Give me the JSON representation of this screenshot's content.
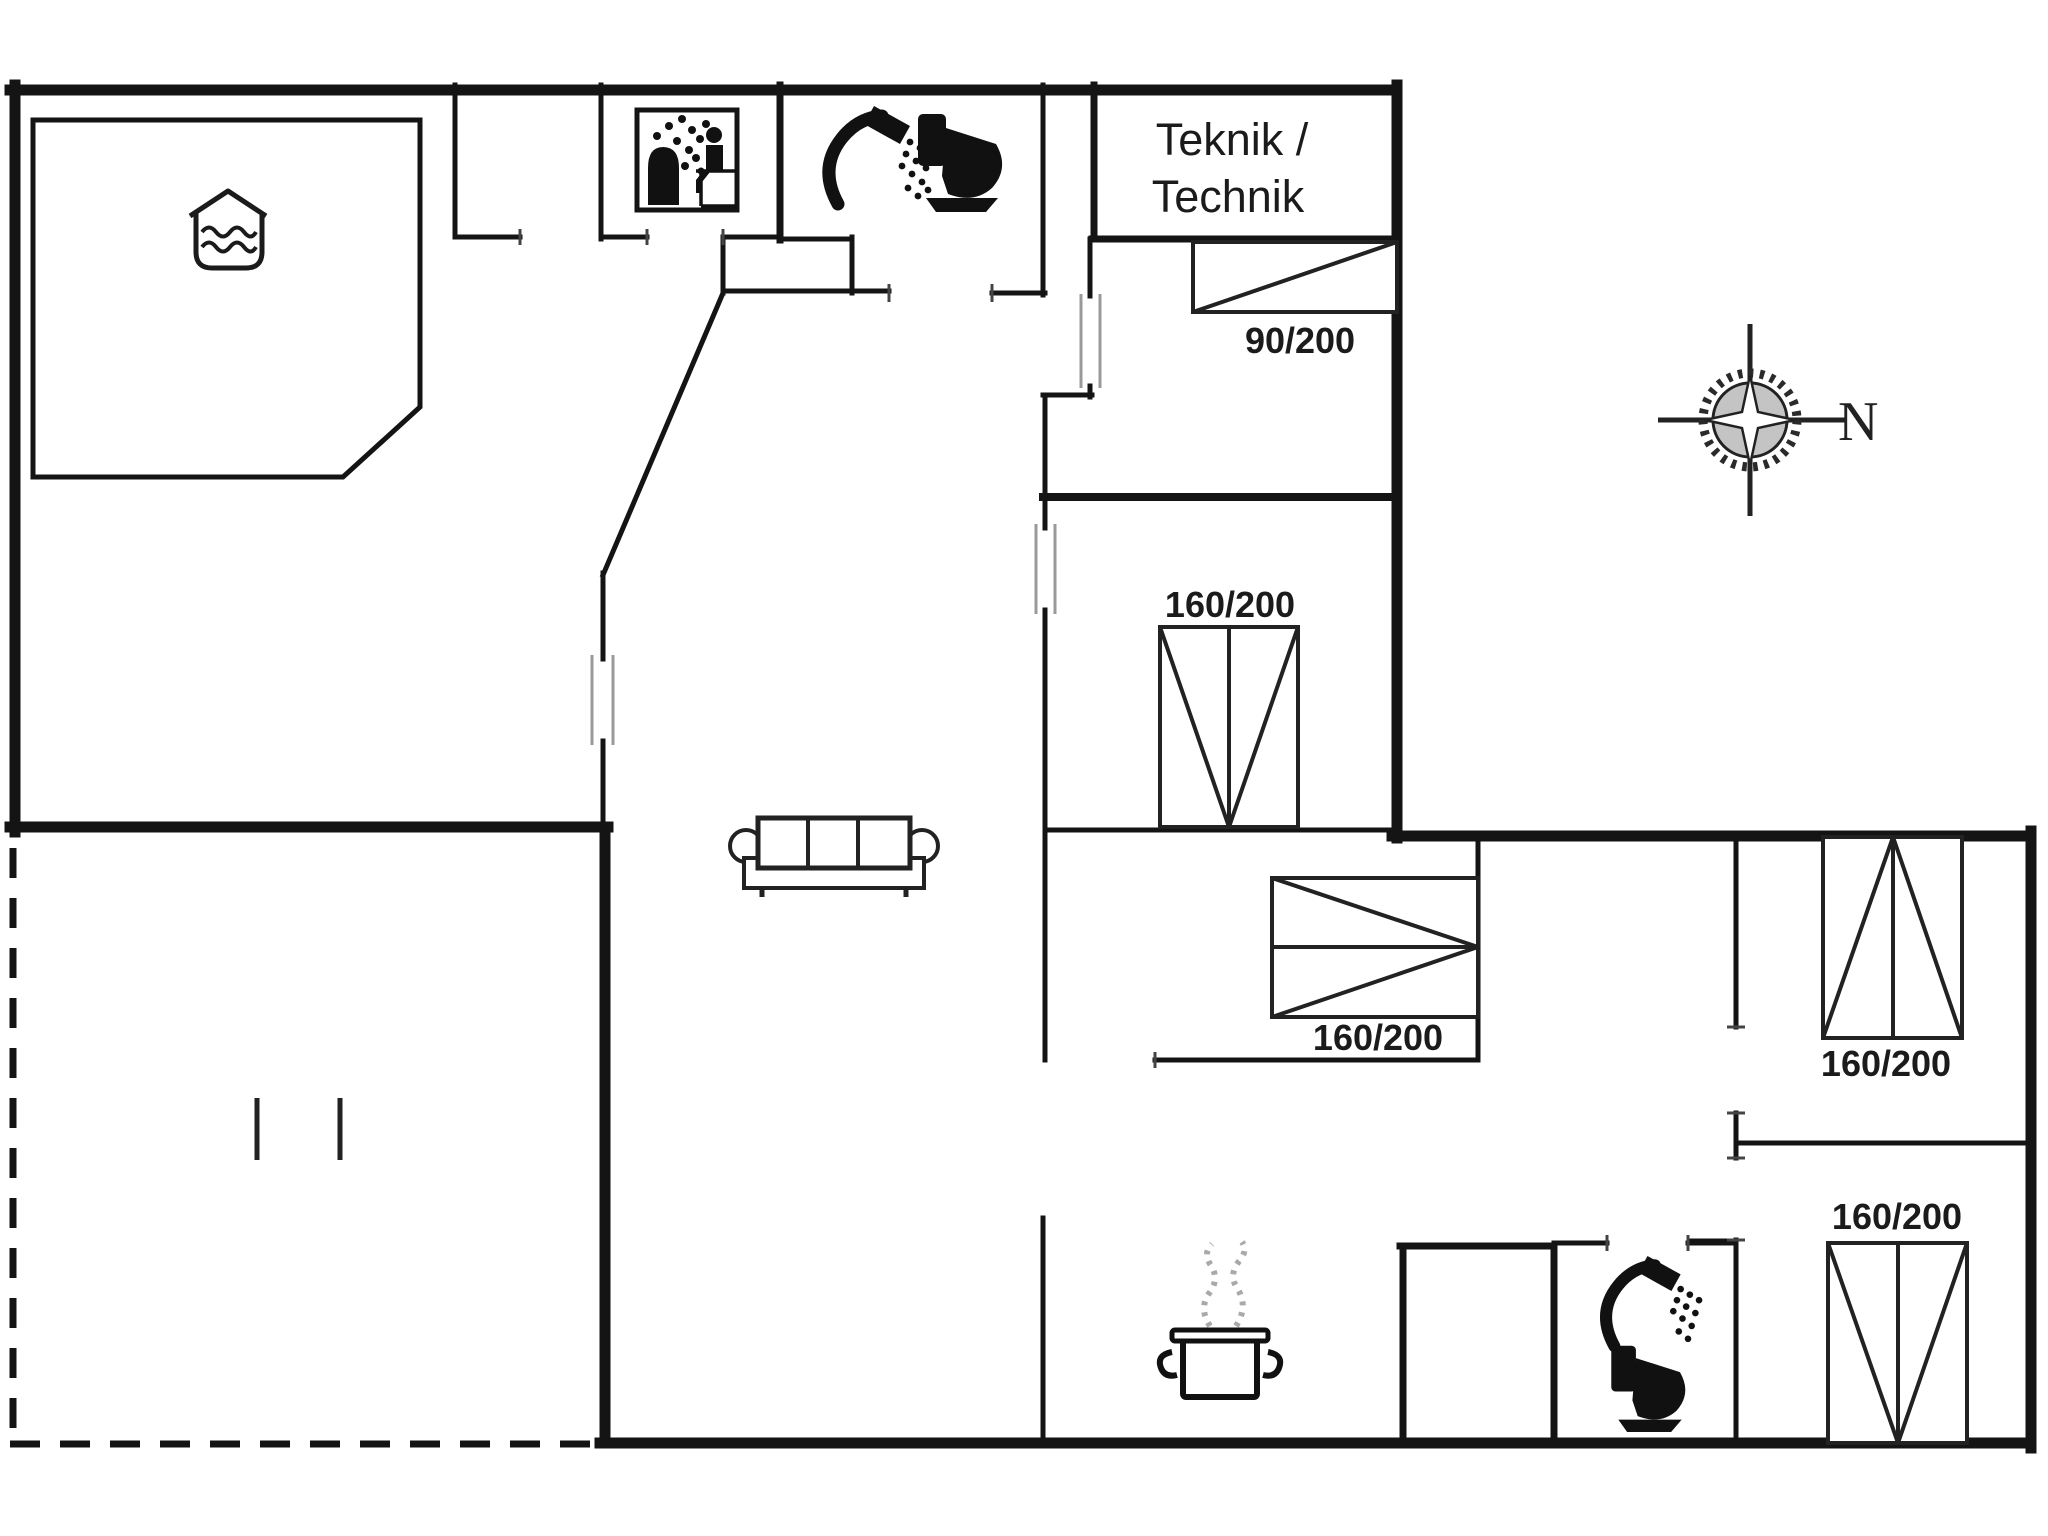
{
  "page": {
    "background": "#ffffff",
    "wall_color": "#141414",
    "furniture_color": "#222222",
    "steam_color": "#a9a9a9"
  },
  "labels": {
    "technical_room_line1": "Teknik /",
    "technical_room_line2": "Technik",
    "compass_north": "N"
  },
  "beds": {
    "bedroom1_single": "90/200",
    "bedroom2_double": "160/200",
    "bedroom3_double": "160/200",
    "bedroom4_double": "160/200",
    "bedroom5_double": "160/200"
  },
  "icons": [
    "whirlpool-icon",
    "sauna-icon",
    "shower-icon",
    "toilet-icon",
    "sofa-icon",
    "cooking-pot-icon",
    "steam-icon",
    "compass-rose-icon"
  ]
}
